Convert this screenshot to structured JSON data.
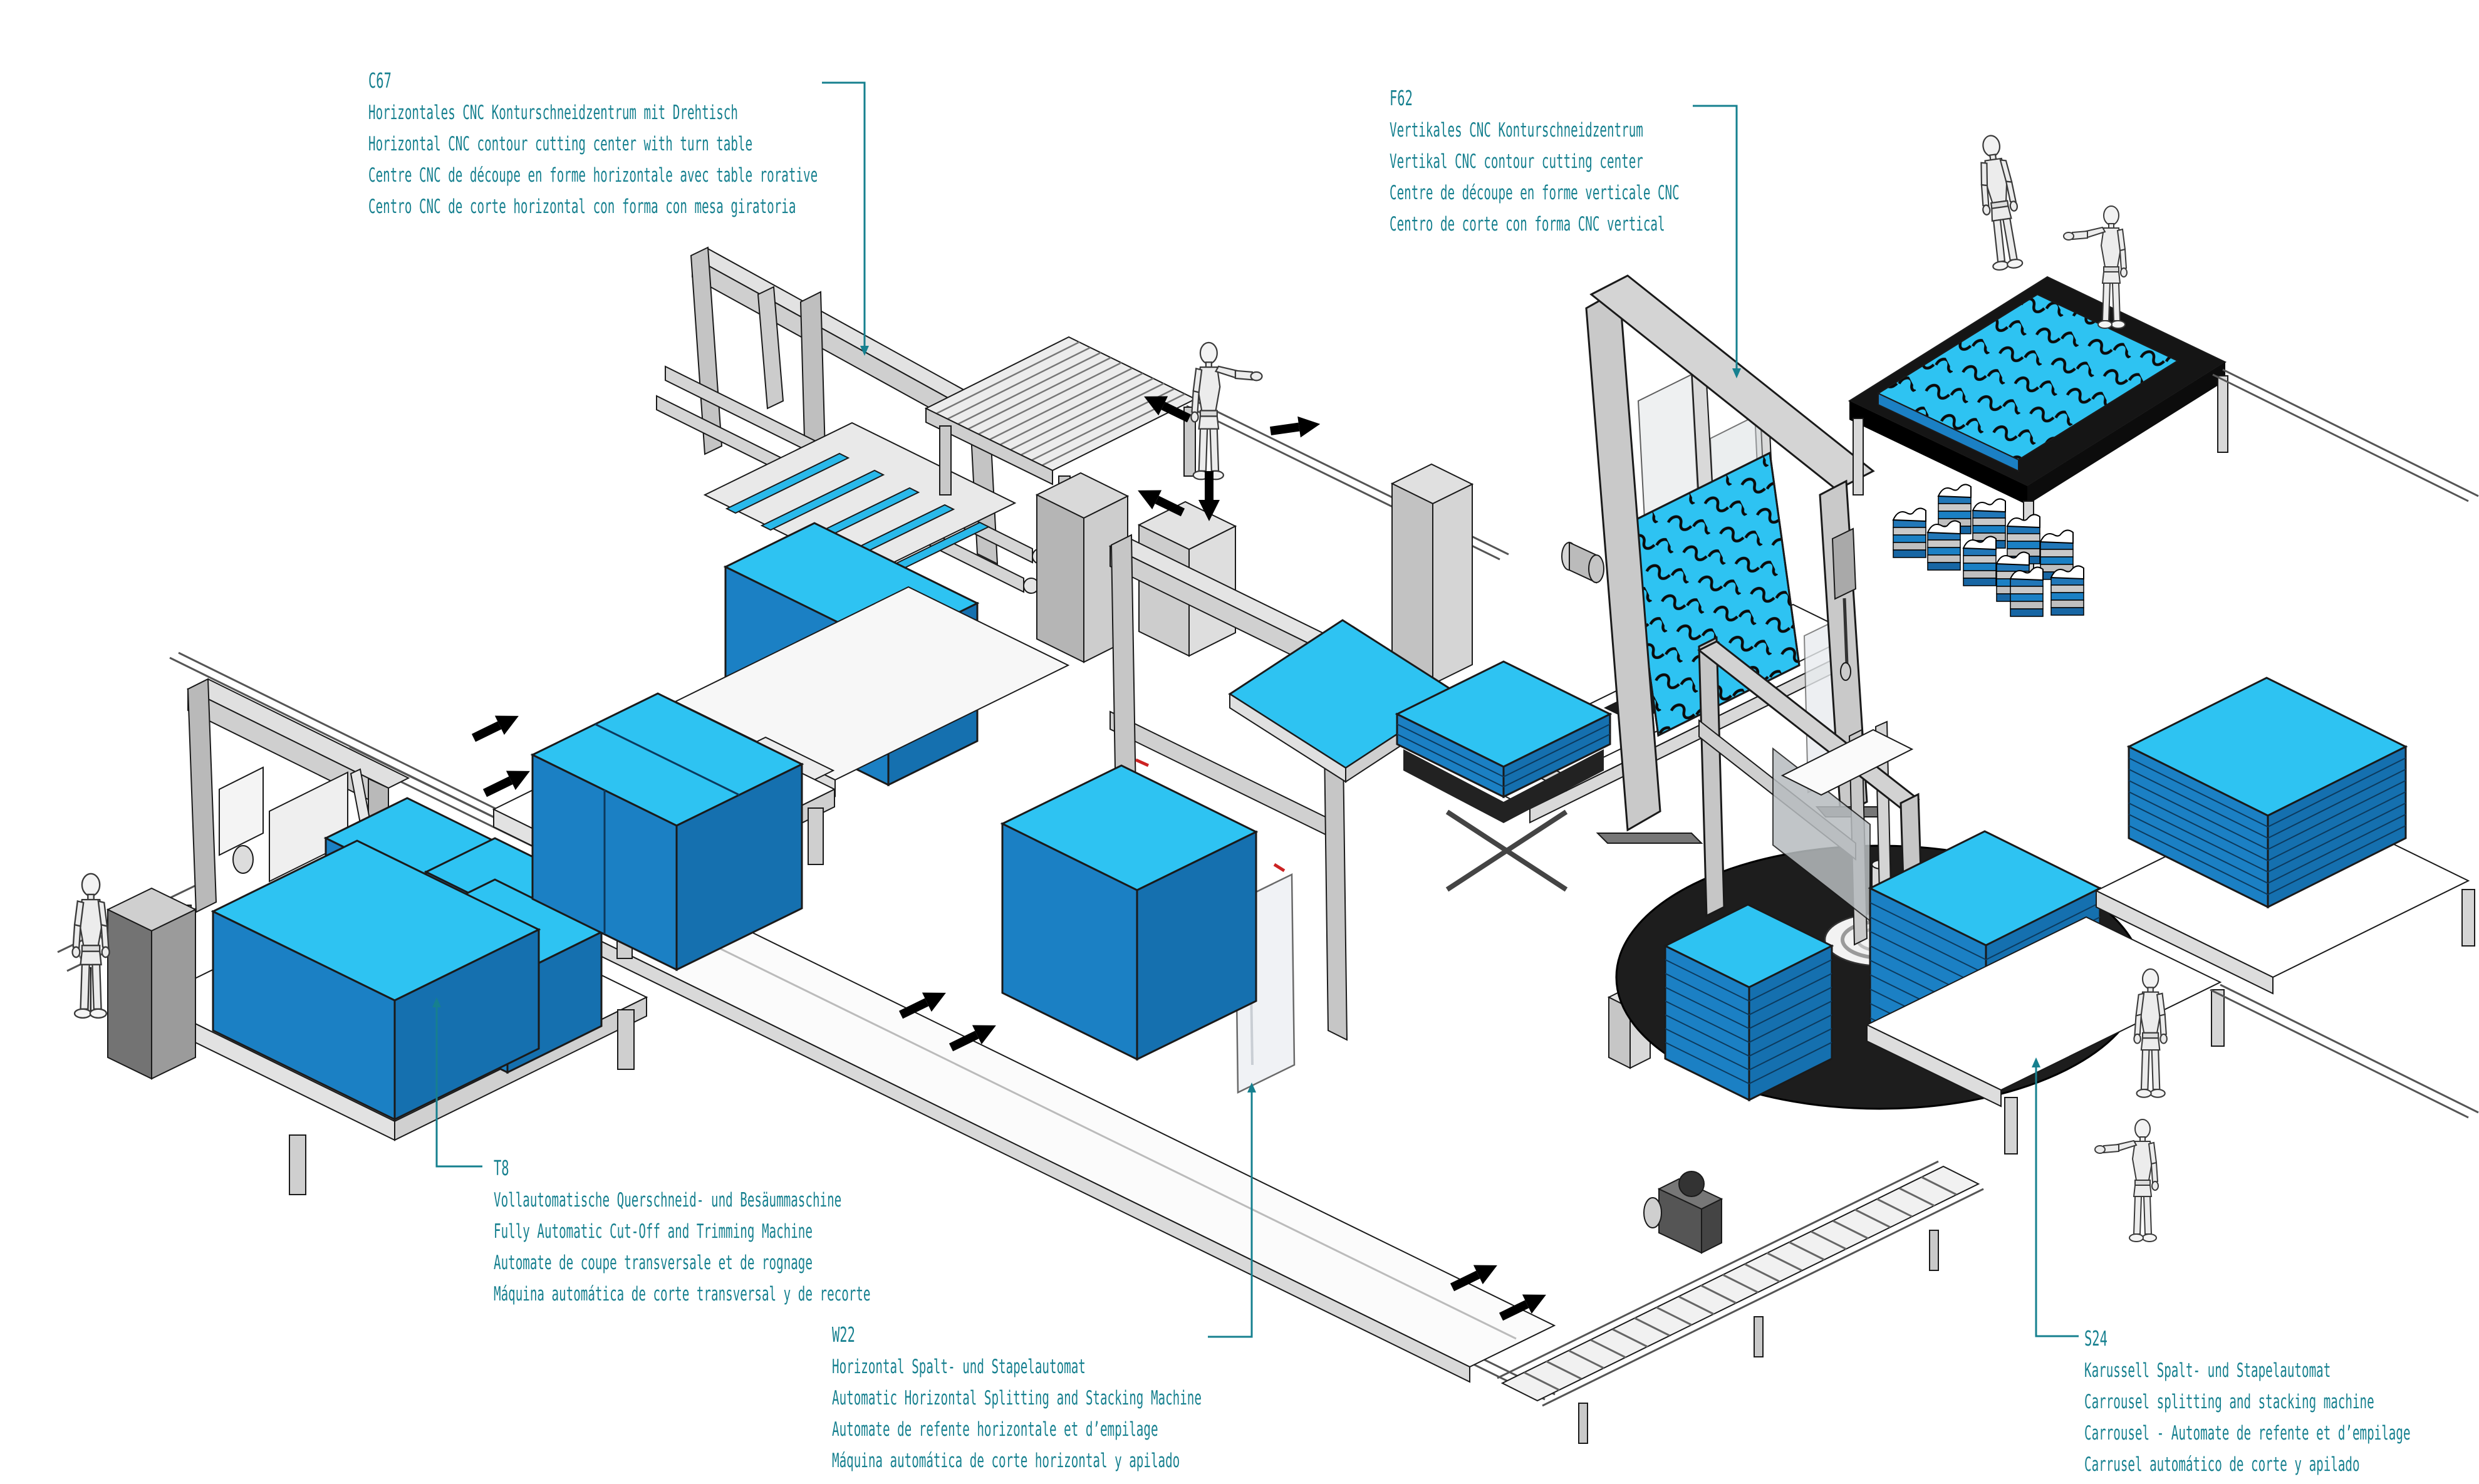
{
  "colors": {
    "accent_teal": "#16808F",
    "foam_top": "#2EC3F2",
    "foam_front": "#1B80C4",
    "foam_side": "#1570AF",
    "carousel_black": "#1D1D1D",
    "machine_gray": "#C9C9C9"
  },
  "machines": [
    {
      "code": "C67",
      "label_de": "Horizontales CNC Konturschneidzentrum mit Drehtisch",
      "label_en": "Horizontal CNC contour cutting center with turn table",
      "label_fr": "Centre CNC de découpe en forme horizontale avec table rorative",
      "label_es": "Centro CNC de corte horizontal con forma con mesa giratoria"
    },
    {
      "code": "F62",
      "label_de": "Vertikales CNC Konturschneidzentrum",
      "label_en": "Vertikal CNC contour cutting center",
      "label_fr": "Centre de découpe en forme verticale CNC",
      "label_es": "Centro de corte con forma CNC vertical"
    },
    {
      "code": "T8",
      "label_de": "Vollautomatische Querschneid- und Besäummaschine",
      "label_en": "Fully Automatic Cut-Off and Trimming Machine",
      "label_fr": "Automate de coupe transversale et de rognage",
      "label_es": "Máquina automática de corte transversal y de recorte"
    },
    {
      "code": "W22",
      "label_de": "Horizontal Spalt- und Stapelautomat",
      "label_en": "Automatic Horizontal Splitting and Stacking Machine",
      "label_fr": "Automate de refente horizontale et d’empilage",
      "label_es": "Máquina automática de corte horizontal y apilado"
    },
    {
      "code": "S24",
      "label_de": "Karussell Spalt- und Stapelautomat",
      "label_en": "Carrousel splitting and stacking machine",
      "label_fr": "Carrousel - Automate de refente et d’empilage",
      "label_es": "Carrusel automático de corte y apilado"
    }
  ]
}
